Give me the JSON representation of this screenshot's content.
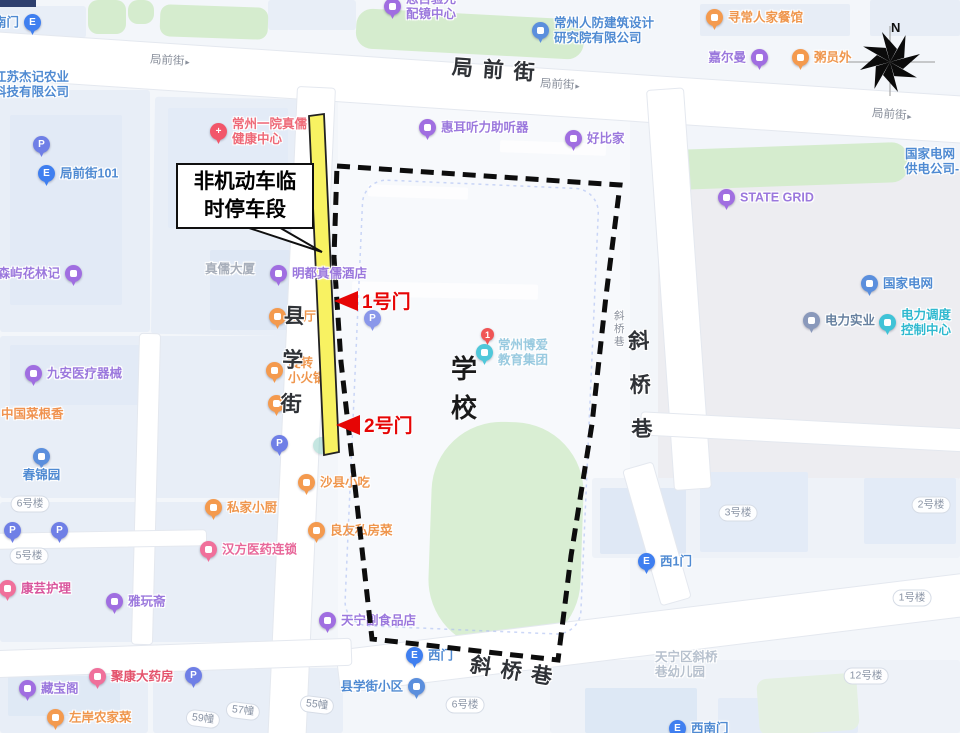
{
  "map": {
    "pois": [
      {
        "t": "exit",
        "x": 32,
        "y": 22,
        "pos": "l",
        "label": "南门"
      },
      {
        "t": "none",
        "x": -6,
        "y": 70,
        "pos": "r",
        "lines": [
          "江苏杰记农业",
          "科技有限公司"
        ],
        "lc": "#4f8ad2"
      },
      {
        "t": "parking",
        "x": 41,
        "y": 144
      },
      {
        "t": "exit",
        "x": 46,
        "y": 173,
        "pos": "r",
        "label": "局前街101"
      },
      {
        "t": "purple",
        "x": 73,
        "y": 273,
        "pos": "l",
        "label": "森屿花林记"
      },
      {
        "t": "hospital",
        "x": 218,
        "y": 131,
        "pos": "r",
        "lines": [
          "常州一院真儒",
          "健康中心"
        ],
        "lc": "#ee6a78"
      },
      {
        "t": "purple",
        "x": 392,
        "y": 6,
        "pos": "r",
        "lines": [
          "思目验光",
          "配镜中心"
        ]
      },
      {
        "t": "blue",
        "x": 540,
        "y": 30,
        "pos": "r",
        "lines": [
          "常州人防建筑设计",
          "研究院有限公司"
        ]
      },
      {
        "t": "orange",
        "x": 714,
        "y": 17,
        "pos": "r",
        "label": "寻常人家餐馆"
      },
      {
        "t": "purple",
        "x": 759,
        "y": 57,
        "pos": "l",
        "label": "嘉尔曼"
      },
      {
        "t": "orange",
        "x": 800,
        "y": 57,
        "pos": "r",
        "label": "粥员外"
      },
      {
        "t": "purple",
        "x": 427,
        "y": 127,
        "pos": "r",
        "label": "惠耳听力助听器"
      },
      {
        "t": "purple",
        "x": 573,
        "y": 138,
        "pos": "r",
        "label": "好比家"
      },
      {
        "t": "none",
        "x": 905,
        "y": 147,
        "pos": "r",
        "lines": [
          "国家电网",
          "供电公司-"
        ],
        "lc": "#4f8ad2"
      },
      {
        "t": "purple",
        "x": 726,
        "y": 197,
        "pos": "r",
        "label": "STATE GRID"
      },
      {
        "t": "blue",
        "x": 869,
        "y": 283,
        "pos": "r",
        "label": "国家电网"
      },
      {
        "t": "slate",
        "x": 811,
        "y": 320,
        "pos": "r",
        "label": "电力实业",
        "lc": "#66809f"
      },
      {
        "t": "teal",
        "x": 887,
        "y": 322,
        "pos": "r",
        "lines": [
          "电力调度",
          "控制中心"
        ]
      },
      {
        "t": "none",
        "x": 205,
        "y": 262,
        "pos": "r",
        "label": "真儒大厦",
        "lc": "#a7aeba"
      },
      {
        "t": "purple",
        "x": 278,
        "y": 273,
        "pos": "r",
        "label": "明都真儒酒店",
        "z": 26
      },
      {
        "t": "orange",
        "x": 277,
        "y": 316,
        "pos": "r",
        "label": "餐厅"
      },
      {
        "t": "orange",
        "x": 274,
        "y": 370,
        "pos": "r",
        "lines": [
          "旋转",
          "小火锅"
        ]
      },
      {
        "t": "orange",
        "x": 276,
        "y": 403
      },
      {
        "t": "parking",
        "x": 279,
        "y": 443
      },
      {
        "t": "dot",
        "x": 321,
        "y": 445
      },
      {
        "t": "parking",
        "x": 372,
        "y": 318,
        "op": 0.8
      },
      {
        "t": "red1",
        "x": 489,
        "y": 336
      },
      {
        "t": "teal",
        "x": 484,
        "y": 352,
        "pos": "r",
        "lines": [
          "常州博爱",
          "教育集团"
        ],
        "lc": "#8fc6dd",
        "op": 0.9
      },
      {
        "t": "purple",
        "x": 33,
        "y": 373,
        "pos": "r",
        "label": "九安医疗器械"
      },
      {
        "t": "none",
        "x": 1,
        "y": 407,
        "pos": "r",
        "label": "中国菜根香",
        "lc": "#f0924f"
      },
      {
        "t": "blue",
        "x": 41,
        "y": 456,
        "pos": "b",
        "label": "春锦园"
      },
      {
        "t": "parking",
        "x": 12,
        "y": 530
      },
      {
        "t": "parking",
        "x": 59,
        "y": 530
      },
      {
        "t": "pink",
        "x": 7,
        "y": 588,
        "pos": "r",
        "label": "康芸护理",
        "lc": "#d9549c"
      },
      {
        "t": "purple",
        "x": 114,
        "y": 601,
        "pos": "r",
        "label": "雅玩斋"
      },
      {
        "t": "orange",
        "x": 213,
        "y": 507,
        "pos": "r",
        "label": "私家小厨"
      },
      {
        "t": "orange",
        "x": 306,
        "y": 482,
        "pos": "r",
        "label": "沙县小吃"
      },
      {
        "t": "orange",
        "x": 316,
        "y": 530,
        "pos": "r",
        "label": "良友私房菜"
      },
      {
        "t": "pink",
        "x": 208,
        "y": 549,
        "pos": "r",
        "label": "汉方医药连锁"
      },
      {
        "t": "purple",
        "x": 327,
        "y": 620,
        "pos": "r",
        "label": "天宁副食品店"
      },
      {
        "t": "purple",
        "x": 27,
        "y": 688,
        "pos": "r",
        "label": "藏宝阁"
      },
      {
        "t": "pink",
        "x": 97,
        "y": 676,
        "pos": "r",
        "label": "聚康大药房",
        "lc": "#e4556e"
      },
      {
        "t": "orange",
        "x": 55,
        "y": 717,
        "pos": "r",
        "label": "左岸农家菜"
      },
      {
        "t": "parking",
        "x": 193,
        "y": 675
      },
      {
        "t": "blue",
        "x": 416,
        "y": 686,
        "pos": "l",
        "label": "县学街小区"
      },
      {
        "t": "exit",
        "x": 414,
        "y": 655,
        "pos": "r",
        "label": "西门"
      },
      {
        "t": "exit",
        "x": 646,
        "y": 561,
        "pos": "r",
        "label": "西1门"
      },
      {
        "t": "none",
        "x": 655,
        "y": 650,
        "pos": "r",
        "lines": [
          "天宁区斜桥",
          "巷幼儿园"
        ],
        "lc": "#b7c1ce"
      },
      {
        "t": "exit",
        "x": 677,
        "y": 728,
        "pos": "r",
        "label": "西南门"
      }
    ],
    "badges": [
      {
        "text": "6号楼",
        "x": 30,
        "y": 504,
        "rot": 0
      },
      {
        "text": "5号楼",
        "x": 29,
        "y": 556,
        "rot": 0
      },
      {
        "text": "59幢",
        "x": 203,
        "y": 719,
        "rot": 7
      },
      {
        "text": "57幢",
        "x": 243,
        "y": 711,
        "rot": 7
      },
      {
        "text": "55幢",
        "x": 317,
        "y": 705,
        "rot": 7
      },
      {
        "text": "6号楼",
        "x": 465,
        "y": 705,
        "rot": 0
      },
      {
        "text": "3号楼",
        "x": 738,
        "y": 513,
        "rot": 0
      },
      {
        "text": "2号楼",
        "x": 931,
        "y": 505,
        "rot": 0
      },
      {
        "text": "1号楼",
        "x": 912,
        "y": 598,
        "rot": 0
      },
      {
        "text": "12号楼",
        "x": 866,
        "y": 676,
        "rot": 0
      }
    ],
    "streets": [
      {
        "text": "局前街",
        "x": 150,
        "y": 52,
        "cls": "small",
        "rot": 3,
        "arrow": true
      },
      {
        "text": "局 前 街",
        "x": 452,
        "y": 54,
        "cls": "big",
        "rot": 4,
        "arrow": false
      },
      {
        "text": "局前街",
        "x": 540,
        "y": 76,
        "cls": "small",
        "rot": 3,
        "arrow": true
      },
      {
        "text": "局前街",
        "x": 872,
        "y": 106,
        "cls": "small",
        "rot": 4,
        "arrow": true
      },
      {
        "text": "县学街",
        "x": 282,
        "y": 300,
        "cls": "bigv",
        "rot": 2,
        "arrow": false
      },
      {
        "text": "斜桥巷",
        "x": 614,
        "y": 308,
        "cls": "smallv",
        "rot": 0,
        "arrow": false
      },
      {
        "text": "斜桥巷",
        "x": 630,
        "y": 325,
        "cls": "bigv",
        "rot": -2,
        "arrow": false
      },
      {
        "text": "斜 桥 巷",
        "x": 470,
        "y": 655,
        "cls": "big",
        "rot": 9,
        "arrow": false
      }
    ]
  },
  "overlay": {
    "callout": {
      "line1": "非机动车临",
      "line2": "时停车段"
    },
    "gates": [
      {
        "label": "1号门"
      },
      {
        "label": "2号门"
      }
    ],
    "school_label": {
      "line1": "学",
      "line2": "校"
    },
    "compass_n": "N"
  },
  "colors": {
    "highlight_yellow": "#f8f262",
    "boundary_black": "#0d0d0d",
    "gate_red": "#e60505",
    "green_area": "#d5ecce"
  }
}
